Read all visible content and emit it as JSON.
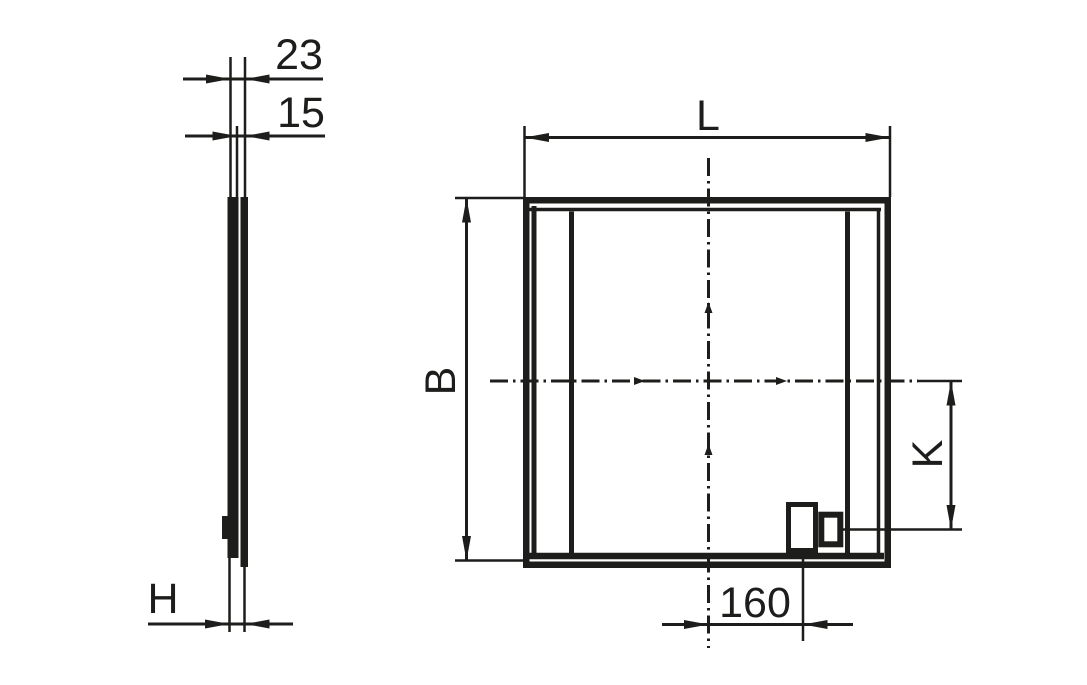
{
  "colors": {
    "ink": "#1d1d1b",
    "background": "#ffffff"
  },
  "side_view": {
    "dim_depth_total": "23",
    "dim_depth_panel": "15",
    "dim_height": "H"
  },
  "front_view": {
    "dim_length": "L",
    "dim_width": "B",
    "dim_gland_spacing": "K",
    "dim_gland_offset": "160"
  }
}
